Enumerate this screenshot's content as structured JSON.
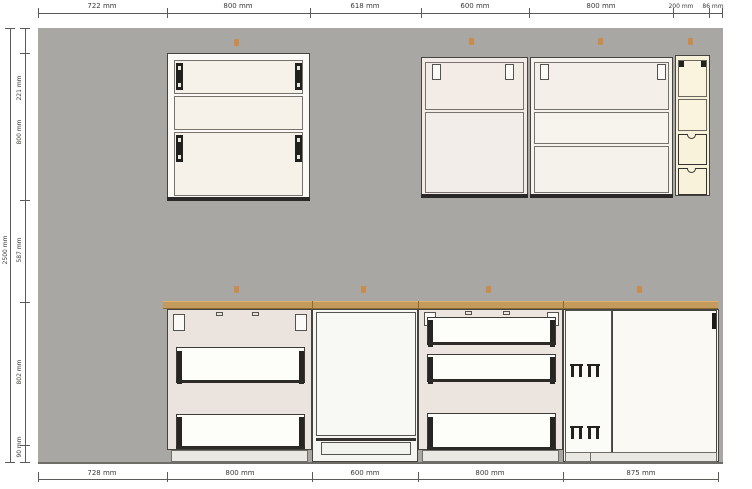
{
  "drawing": {
    "kind": "kitchen-elevation",
    "unit": "mm"
  },
  "dims": {
    "top": [
      {
        "label": "722 mm"
      },
      {
        "label": "800 mm"
      },
      {
        "label": "618 mm"
      },
      {
        "label": "600 mm"
      },
      {
        "label": "800 mm"
      },
      {
        "label": "200 mm"
      },
      {
        "label": "86 mm"
      }
    ],
    "bottom": [
      {
        "label": "728 mm"
      },
      {
        "label": "800 mm"
      },
      {
        "label": "600 mm"
      },
      {
        "label": "800 mm"
      },
      {
        "label": "875 mm"
      }
    ],
    "left": [
      {
        "label": "221 mm"
      },
      {
        "label": "800 mm"
      },
      {
        "label": "587 mm"
      },
      {
        "label": "802 mm"
      },
      {
        "label": "90 mm"
      }
    ],
    "overall_height": {
      "label": "2500 mm"
    }
  },
  "colors": {
    "wall": "#a8a7a3",
    "counter": "#c49b5d",
    "marker": "#cf873d",
    "dim_line": "#5b5a56",
    "dim_text": "#3b3b38",
    "outline": "#45443f",
    "hardware": "#21201d",
    "carcass_pink": "#ebe3dd",
    "cream_front": "#f6f2ea",
    "ivory": "#f8f1da",
    "drawer_white": "#fdfdf9",
    "plinth": "#e9e8e3",
    "floor": "#6f6d68",
    "white_panel": "#faf9f4"
  }
}
